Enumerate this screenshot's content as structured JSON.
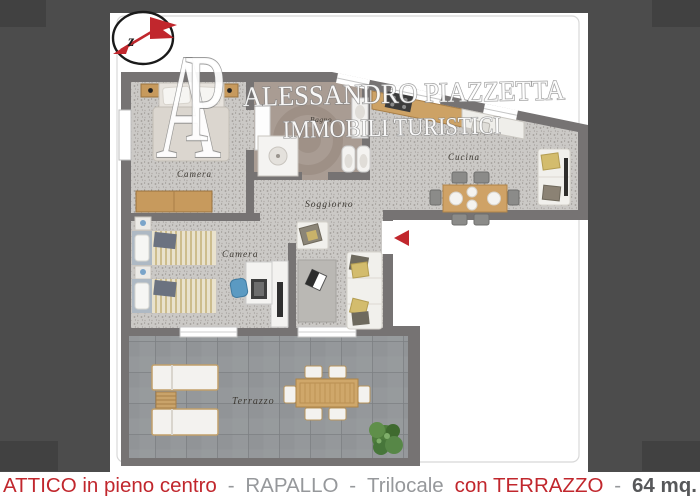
{
  "caption": {
    "segments": [
      {
        "text": "ATTICO in pieno centro",
        "style": "red"
      },
      {
        "text": "-",
        "style": "gray"
      },
      {
        "text": "RAPALLO",
        "style": "gray"
      },
      {
        "text": "-",
        "style": "gray"
      },
      {
        "text": "Trilocale",
        "style": "gray"
      },
      {
        "text": "con TERRAZZO",
        "style": "red"
      },
      {
        "text": "-",
        "style": "gray"
      },
      {
        "text": "64 mq.",
        "style": "dark"
      }
    ]
  },
  "watermark": {
    "monogram": {
      "a": "A",
      "p": "P"
    },
    "line1": "ALESSANDRO PIAZZETTA",
    "line2": "IMMOBILI TURISTICI"
  },
  "floorplan": {
    "compass": {
      "letter": "z"
    },
    "rooms": [
      {
        "id": "camera1",
        "label": "Camera"
      },
      {
        "id": "bagno",
        "label": "Bagno"
      },
      {
        "id": "cucina",
        "label": "Cucina"
      },
      {
        "id": "soggiorno",
        "label": "Soggiorno"
      },
      {
        "id": "camera2",
        "label": "Camera"
      },
      {
        "id": "terrazzo",
        "label": "Terrazzo"
      }
    ]
  },
  "colors": {
    "accent_red": "#c1272d",
    "caption_gray": "#96989b",
    "caption_dark": "#57585a",
    "wall_gray": "#767373",
    "wood_tan": "#cda265"
  }
}
